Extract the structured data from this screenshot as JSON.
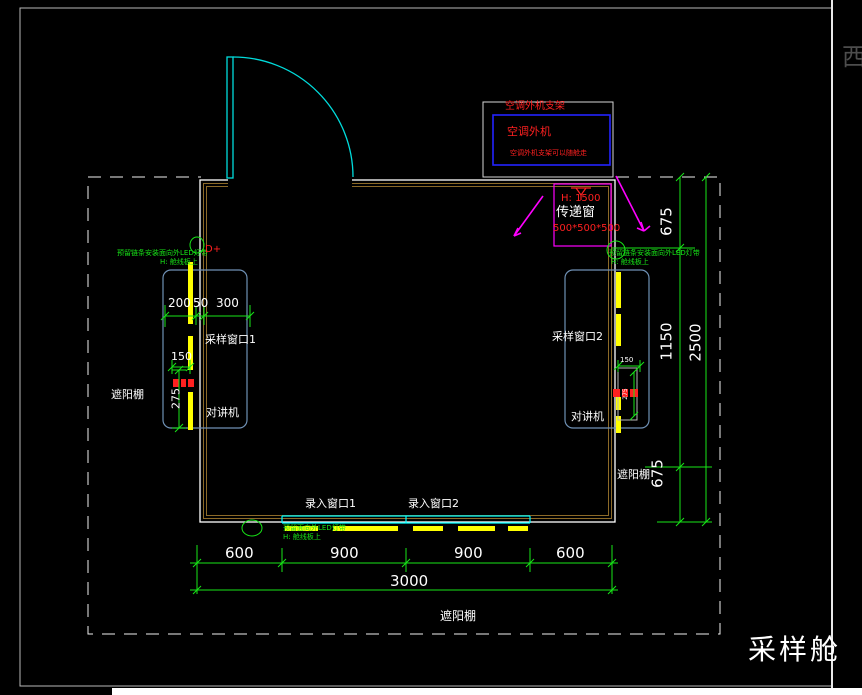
{
  "drawing_title": "采样舱",
  "corner_mark": "西",
  "ac": {
    "bracket_label": "空调外机支架",
    "unit_label": "空调外机",
    "note": "空调外机支架可以随舱走"
  },
  "transfer": {
    "height": "H: 1500",
    "name": "传递窗",
    "size": "500*500*500"
  },
  "left": {
    "led_note": "预留链条安装面向外LED灯带",
    "led_height": "H: 舱线板上",
    "terminal": "D+",
    "dim_a": "200",
    "dim_b": "50",
    "dim_c": "300",
    "window_label": "采样窗口1",
    "dim_d": "150",
    "dim_e": "275",
    "intercom": "对讲机",
    "canopy": "遮阳棚"
  },
  "right": {
    "led_note": "预留链条安装面向外LED灯带",
    "led_height": "H: 舱线板上",
    "window_label": "采样窗口2",
    "dim_d": "150",
    "dim_e": "275",
    "intercom": "对讲机",
    "canopy": "遮阳棚",
    "dim_top": "675",
    "dim_mid": "1150",
    "dim_total": "2500",
    "dim_bottom": "675"
  },
  "bottom": {
    "entry1": "录入窗口1",
    "entry2": "录入窗口2",
    "led_note": "预留面向外LED灯带",
    "led_height": "H: 舱线板上",
    "dim_1": "600",
    "dim_2": "900",
    "dim_3": "900",
    "dim_4": "600",
    "dim_total": "3000",
    "canopy": "遮阳棚"
  },
  "colors": {
    "dimension_green": "#17e617",
    "annotation_red": "#ff2020",
    "wall_brown": "#8c6a28",
    "door_cyan": "#00dcdc",
    "window_cyan": "#00ffff",
    "led_yellow": "#ffff00",
    "transfer_magenta": "#ff00ff",
    "region_blue": "#6f91b5",
    "ac_blue": "#2424ff"
  }
}
